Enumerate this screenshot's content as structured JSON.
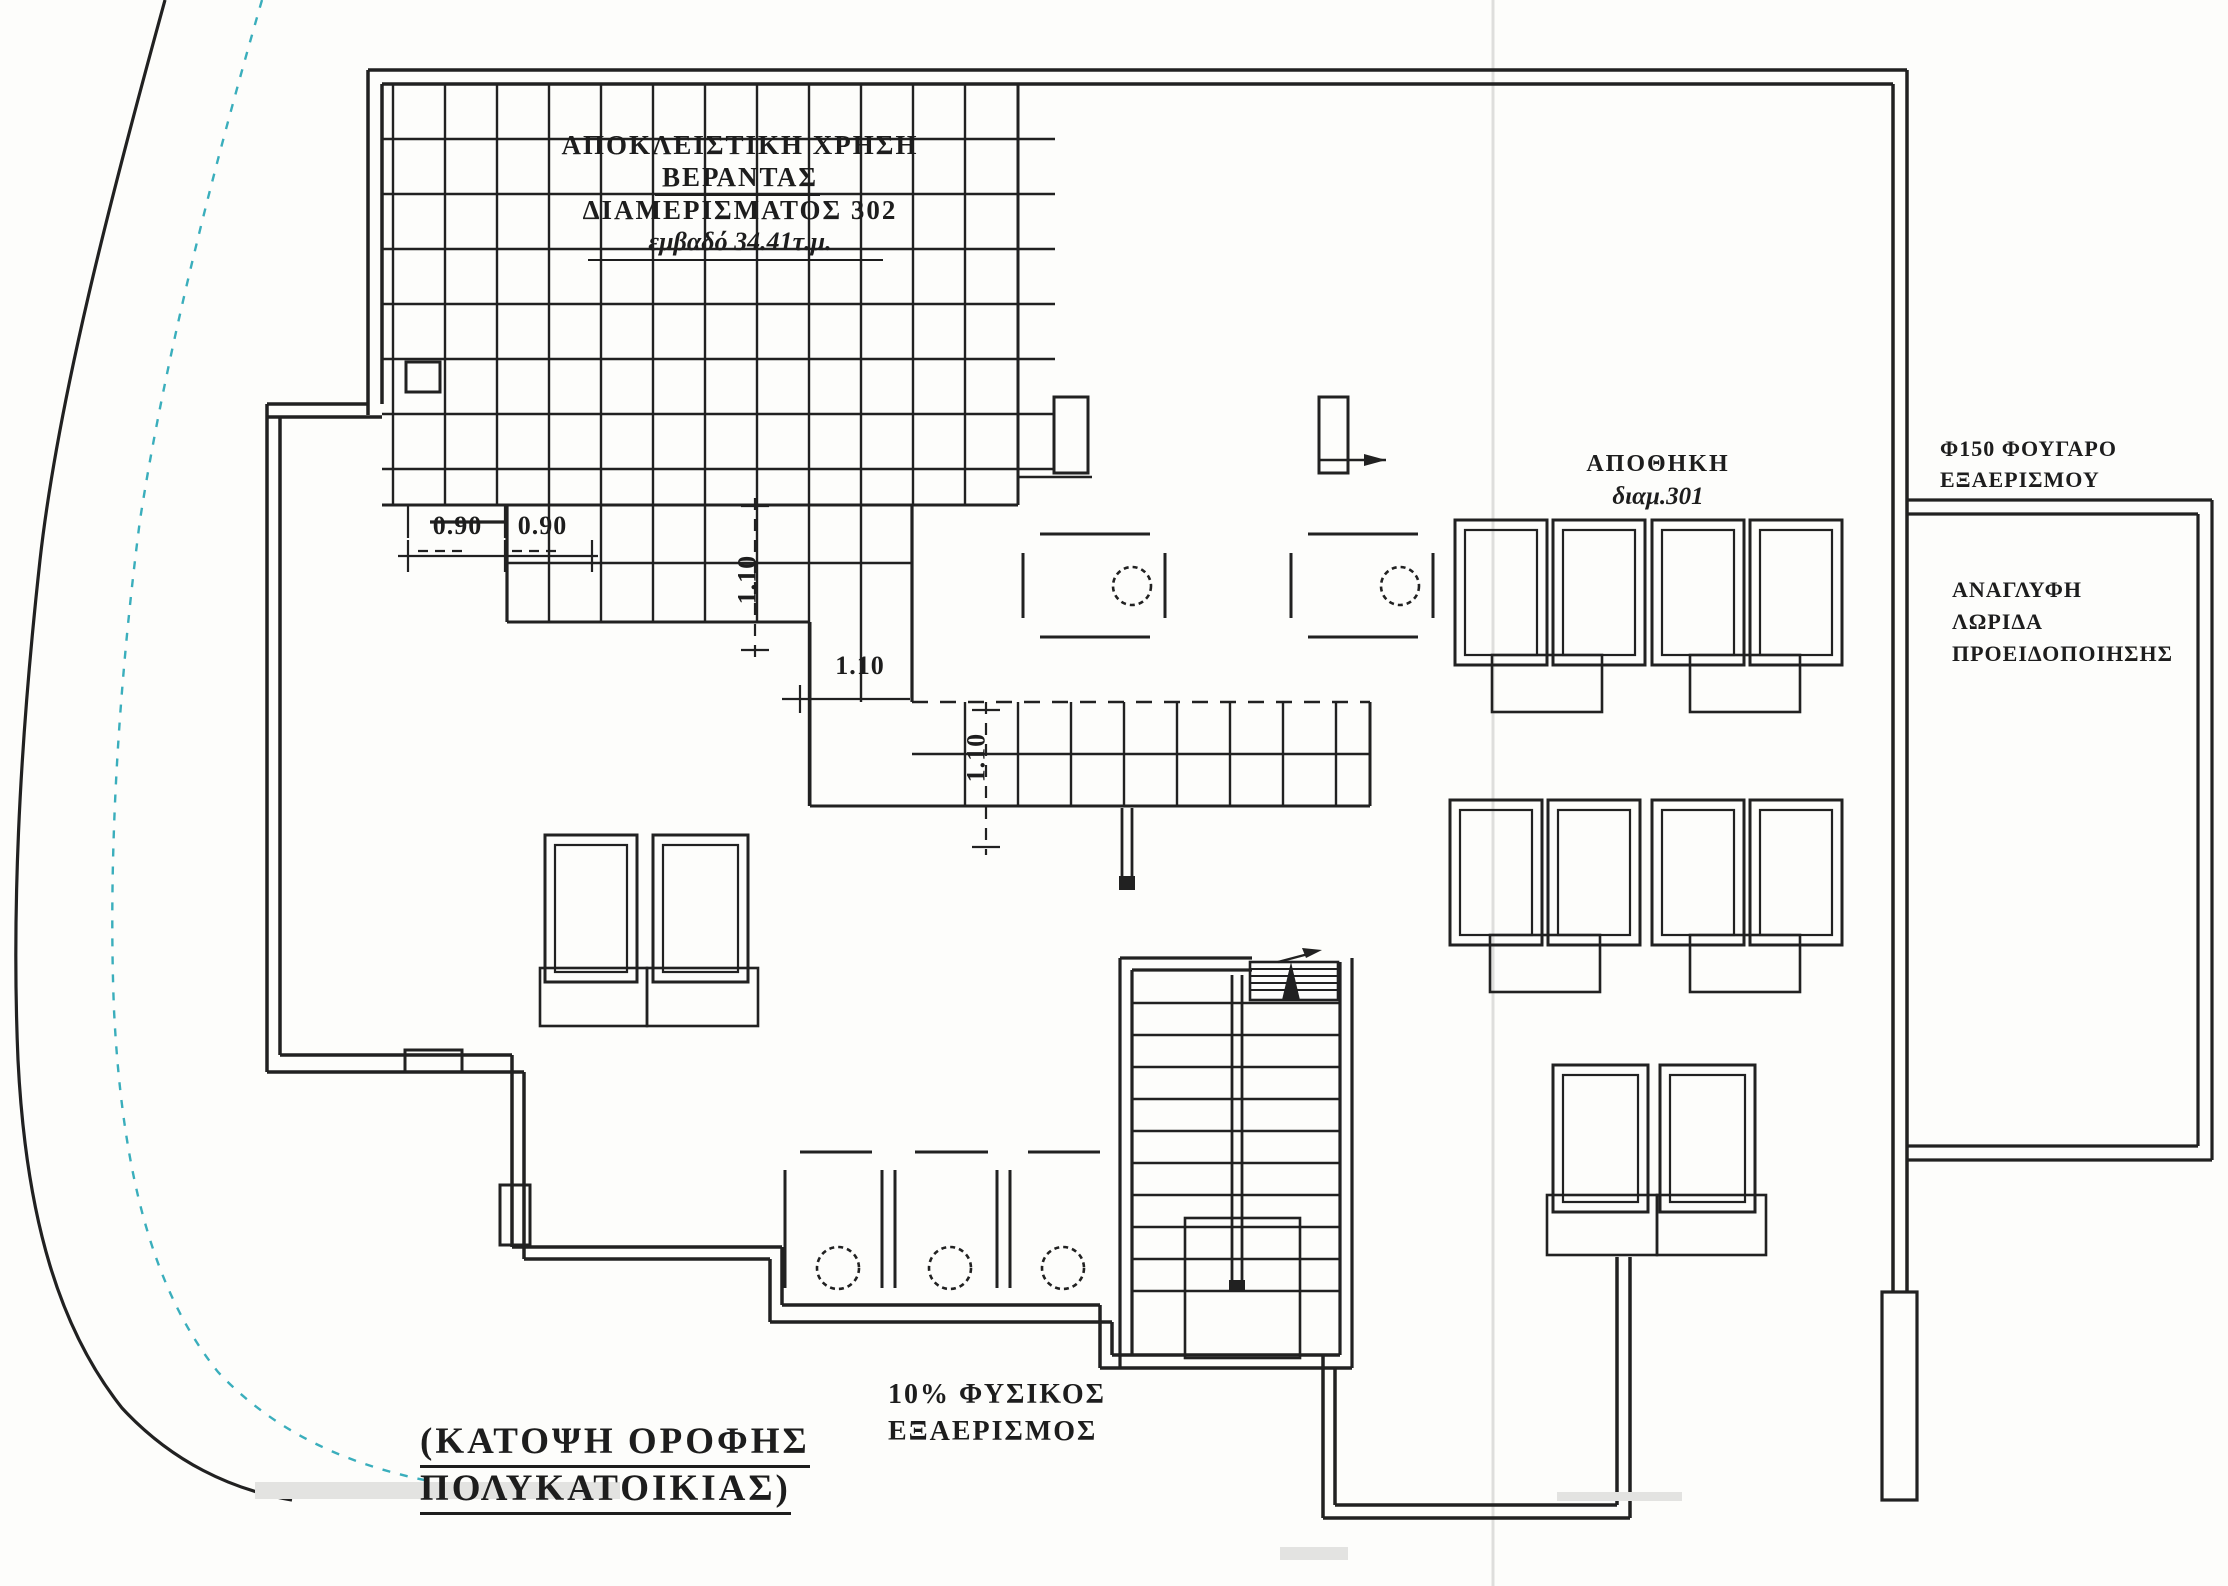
{
  "page": {
    "kind": "architectural roof plan (scanned drawing)",
    "background": "#fdfdfb"
  },
  "colors": {
    "ink": "#212121",
    "setback_teal": "#3aaebc",
    "scan_fold_gray": "#dededc",
    "artifact_gray": "#e3e3e1"
  },
  "annotations": {
    "veranda_note": {
      "line1": "ΑΠΟΚΛΕΙΣΤΙΚΗ ΧΡΗΣΗ",
      "line2": "ΒΕΡΑΝΤΑΣ",
      "line3": "ΔΙΑΜΕΡΙΣΜΑΤΟΣ 302",
      "line4": "εμβαδό 34.41τ.μ."
    },
    "storage_note": {
      "line1": "ΑΠΟΘΗΚΗ",
      "line2": "διαμ.301"
    },
    "flue_note": {
      "line1": "Φ150 ΦΟΥΓΑΡΟ",
      "line2": "ΕΞΑΕΡΙΣΜΟΥ"
    },
    "warning_strip_note": {
      "line1": "ΑΝΑΓΛΥΦΗ",
      "line2": "ΛΩΡΙΔΑ",
      "line3": "ΠΡΟΕΙΔΟΠΟΙΗΣΗΣ"
    },
    "ventilation_note": {
      "line1": "10% ΦΥΣΙΚΟΣ",
      "line2": "ΕΞΑΕΡΙΣΜΟΣ"
    },
    "drawing_title": {
      "line1": "(ΚΑΤΟΨΗ ΟΡΟΦΗΣ",
      "line2": "ΠΟΛΥΚΑΤΟΙΚΙΑΣ)"
    }
  },
  "dimensions": {
    "left_a": "0.90",
    "left_b": "0.90",
    "band_v": "1.10",
    "corridor_h": "1.10",
    "corridor_v": "1.10"
  }
}
